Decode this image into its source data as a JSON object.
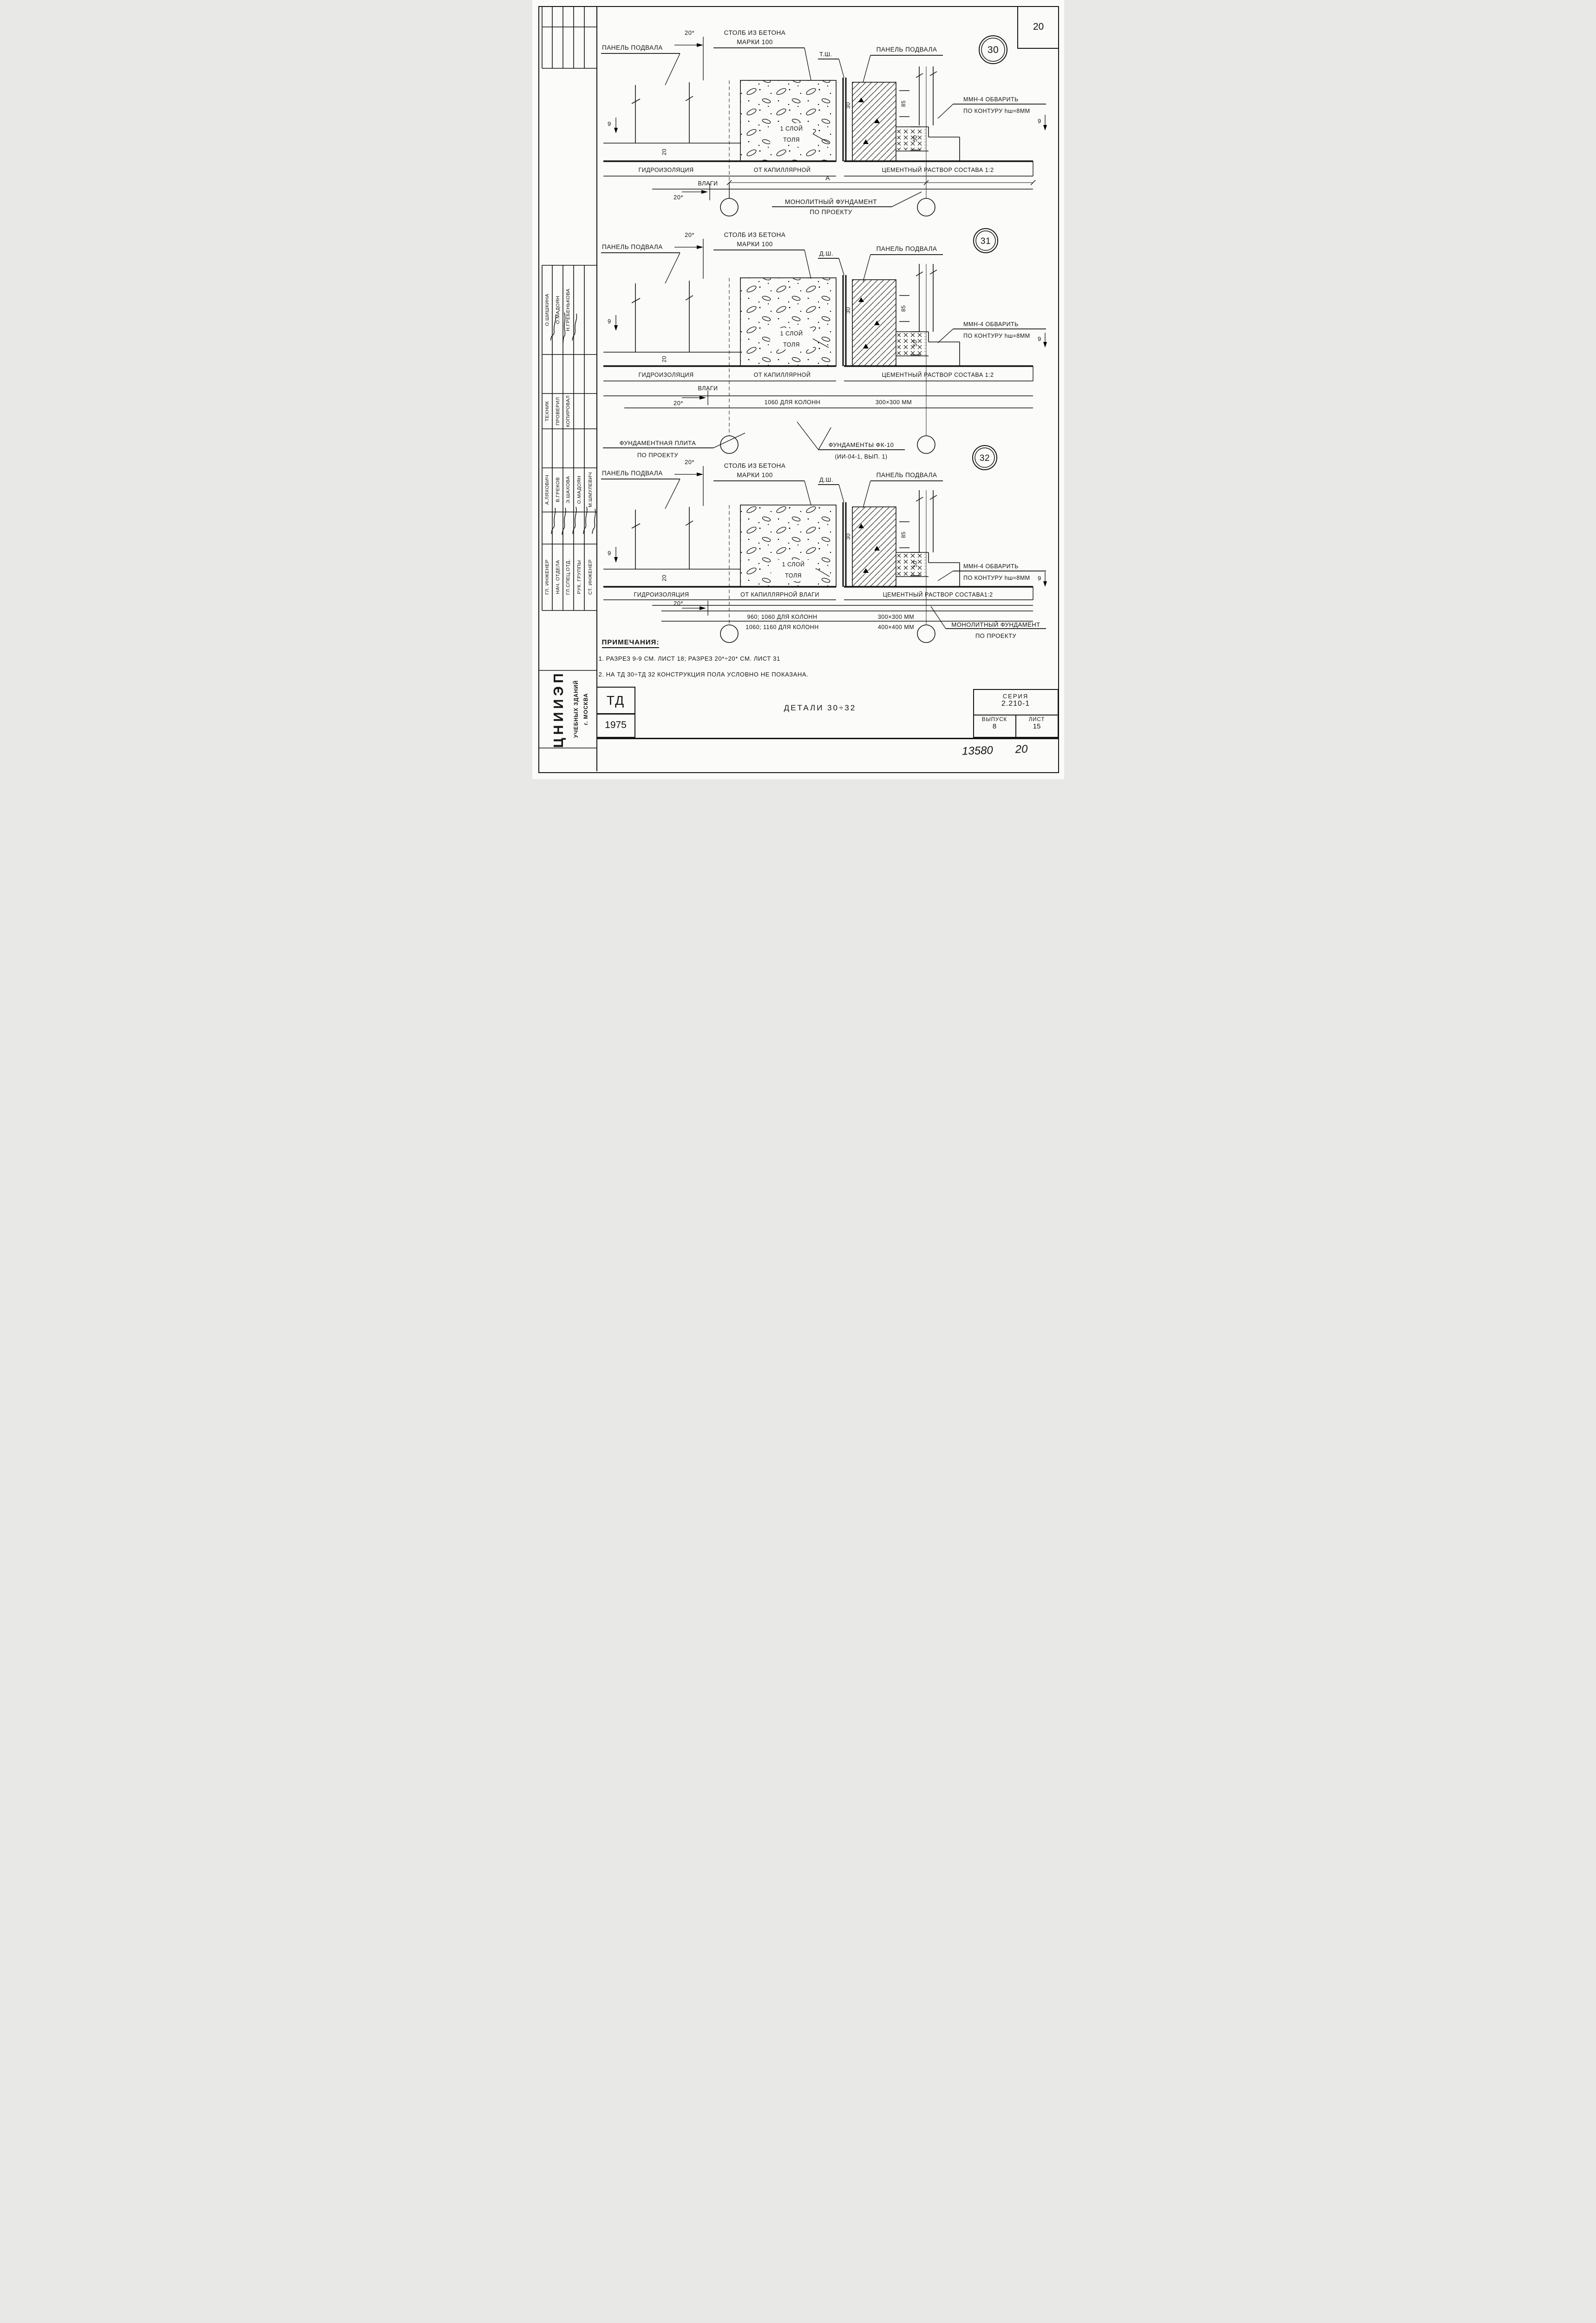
{
  "sheet": {
    "page_number": "20",
    "stamp_number": "13580",
    "stamp_page": "20"
  },
  "title_block": {
    "org_name": "ЦНИИЭП",
    "org_line2": "УЧЕБНЫХ ЗДАНИЙ",
    "org_line3": "г. МОСКВА",
    "mark": "ТД",
    "year": "1975",
    "drawing_title": "ДЕТАЛИ 30÷32",
    "series_label": "СЕРИЯ",
    "series_value": "2.210-1",
    "issue_label": "ВЫПУСК",
    "issue_value": "8",
    "sheet_label": "ЛИСТ",
    "sheet_value": "15"
  },
  "staff": {
    "top_names": [
      "О.ШИШКИНА",
      "О.МАДОЯН",
      "Н.ГРЕБЕНЬКОВА"
    ],
    "top_roles": [
      "ТЕХНИК",
      "ПРОВЕРИЛ",
      "КОПИРОВАЛ"
    ],
    "bottom_names": [
      "А.ЛЯХОВИЧ",
      "В.ГРЕКОВ",
      "Э.ШАХОВА",
      "О.МАДОЯН",
      "М.ШМУЛЕВИЧ"
    ],
    "bottom_roles": [
      "ГЛ. ИНЖЕНЕР",
      "НАЧ. ОТДЕЛА",
      "ГЛ.СПЕЦ.ОТД.",
      "РУК. ГРУППЫ",
      "СТ. ИНЖЕНЕР"
    ]
  },
  "notes": {
    "heading": "ПРИМЕЧАНИЯ:",
    "item1": "1. РАЗРЕЗ 9-9 СМ. ЛИСТ 18; РАЗРЕЗ 20*÷20* СМ. ЛИСТ 31",
    "item2": "2. НА ТД 30÷ТД 32 КОНСТРУКЦИЯ ПОЛА УСЛОВНО НЕ ПОКАЗАНА."
  },
  "details": [
    {
      "number": "30",
      "joint": "Т.Ш.",
      "panel_left": "ПАНЕЛЬ ПОДВАЛА",
      "panel_right": "ПАНЕЛЬ ПОДВАЛА",
      "column_line1": "СТОЛБ ИЗ БЕТОНА",
      "column_line2": "МАРКИ 100",
      "tol_line1": "1 СЛОЙ",
      "tol_line2": "ТОЛЯ",
      "weld_line1": "ММН-4 ОБВАРИТЬ",
      "weld_line2": "ПО КОНТУРУ hш=8ММ",
      "hydro_left": "ГИДРОИЗОЛЯЦИЯ",
      "hydro_mid": "ОТ КАПИЛЛЯРНОЙ",
      "hydro_bottom": "ВЛАГИ",
      "cement": "ЦЕМЕНТНЫЙ РАСТВОР СОСТАВА 1:2",
      "foundation_line1": "МОНОЛИТНЫЙ ФУНДАМЕНТ",
      "foundation_line2": "ПО ПРОЕКТУ",
      "dim_span": "А",
      "dim_offset": "20*",
      "dim_section": "9",
      "dim_slab": "20",
      "dim_joint": "30",
      "dim_85": "85",
      "dim_50": "50"
    },
    {
      "number": "31",
      "joint": "Д.Ш.",
      "panel_left": "ПАНЕЛЬ ПОДВАЛА",
      "panel_right": "ПАНЕЛЬ ПОДВАЛА",
      "column_line1": "СТОЛБ ИЗ БЕТОНА",
      "column_line2": "МАРКИ 100",
      "tol_line1": "1 СЛОЙ",
      "tol_line2": "ТОЛЯ",
      "weld_line1": "ММН-4 ОБВАРИТЬ",
      "weld_line2": "ПО КОНТУРУ hш=8ММ",
      "hydro_left": "ГИДРОИЗОЛЯЦИЯ",
      "hydro_mid": "ОТ КАПИЛЛЯРНОЙ",
      "hydro_bottom": "ВЛАГИ",
      "cement": "ЦЕМЕНТНЫЙ РАСТВОР СОСТАВА 1:2",
      "row1_left": "1060 ДЛЯ КОЛОНН",
      "row1_right": "300×300 ММ",
      "plate_line1": "ФУНДАМЕНТНАЯ ПЛИТА",
      "plate_line2": "ПО ПРОЕКТУ",
      "fk_line1": "ФУНДАМЕНТЫ ФК-10",
      "fk_line2": "(ИИ-04-1, ВЫП. 1)",
      "dim_offset": "20*",
      "dim_section": "9",
      "dim_slab": "20",
      "dim_joint": "30",
      "dim_85": "85",
      "dim_50": "50"
    },
    {
      "number": "32",
      "joint": "Д.Ш.",
      "panel_left": "ПАНЕЛЬ ПОДВАЛА",
      "panel_right": "ПАНЕЛЬ ПОДВАЛА",
      "column_line1": "СТОЛБ ИЗ БЕТОНА",
      "column_line2": "МАРКИ 100",
      "tol_line1": "1 СЛОЙ",
      "tol_line2": "ТОЛЯ",
      "weld_line1": "ММН-4 ОБВАРИТЬ",
      "weld_line2": "ПО КОНТУРУ hш=8ММ",
      "hydro_left": "ГИДРОИЗОЛЯЦИЯ",
      "hydro_mid": "ОТ КАПИЛЛЯРНОЙ ВЛАГИ",
      "cement": "ЦЕМЕНТНЫЙ РАСТВОР СОСТАВА1:2",
      "row1_left": "960; 1060 ДЛЯ КОЛОНН",
      "row1_right": "300×300 ММ",
      "row2_left": "1060; 1160 ДЛЯ КОЛОНН",
      "row2_right": "400×400 ММ",
      "foundation_line1": "МОНОЛИТНЫЙ ФУНДАМЕНТ",
      "foundation_line2": "ПО ПРОЕКТУ",
      "dim_offset": "20*",
      "dim_section": "9",
      "dim_slab": "20",
      "dim_joint": "30",
      "dim_85": "85",
      "dim_50": "50"
    }
  ]
}
